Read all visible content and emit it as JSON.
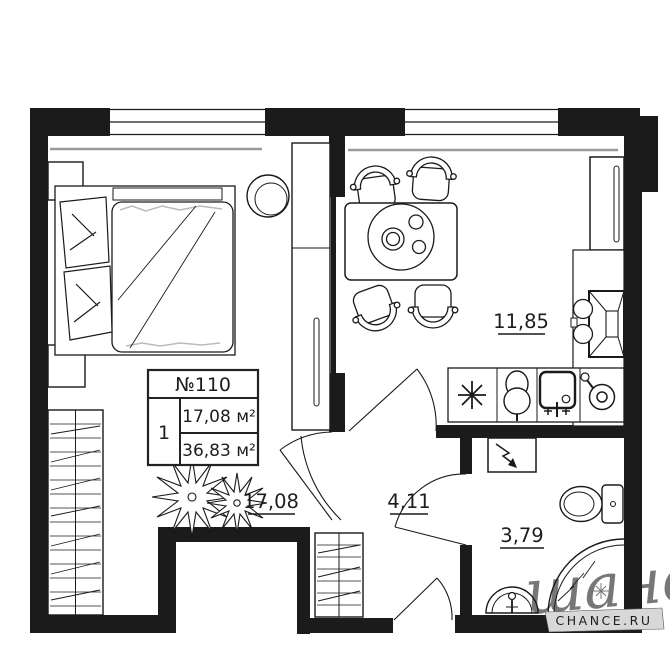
{
  "info_box": {
    "apartment_number": "№110",
    "rooms_count": "1",
    "living_area": "17,08 м²",
    "total_area": "36,83 м²"
  },
  "rooms": [
    {
      "name": "bedroom",
      "area_label": "17,08"
    },
    {
      "name": "kitchen-living",
      "area_label": "11,85"
    },
    {
      "name": "hallway",
      "area_label": "4,11"
    },
    {
      "name": "bathroom",
      "area_label": "3,79"
    }
  ],
  "watermark": {
    "script_text": "шанс",
    "site_label": "CHANCE.RU"
  },
  "colors": {
    "wall": "#1b1b1b",
    "line": "#1a1a1a",
    "sill_gray": "#9a9a9a",
    "watermark_gray": "#8f8f8f",
    "banner_bg": "#d8d8d8",
    "banner_text": "#3a3a3a"
  }
}
